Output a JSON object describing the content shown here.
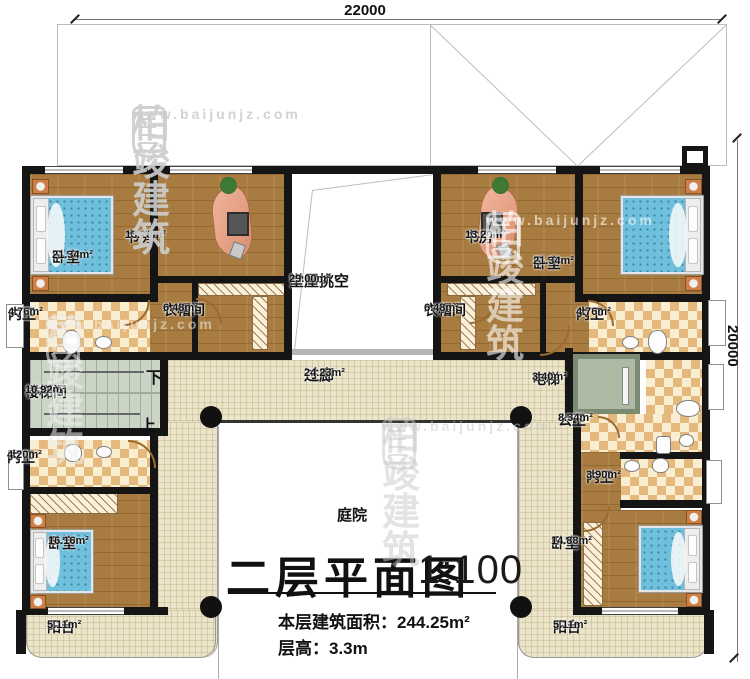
{
  "plan": {
    "title": "二层平面图",
    "scale": "1:100",
    "floor_area_label": "本层建筑面积：",
    "floor_area_value": "244.25m²",
    "floor_height_label": "层高：",
    "floor_height_value": "3.3m"
  },
  "dimensions": {
    "width_mm": "22000",
    "height_mm": "20000"
  },
  "stair": {
    "down": "下",
    "up": "上"
  },
  "watermark": {
    "brand": "柏竣建筑",
    "url": "www.baijunjz.com"
  },
  "rooms": [
    {
      "name": "卧室",
      "area": "21.34m²",
      "x": 127,
      "y": 250,
      "big": false
    },
    {
      "name": "书房",
      "area": "13.20m²",
      "x": 200,
      "y": 230,
      "big": false
    },
    {
      "name": "堂屋挑空",
      "area": "29.00m²",
      "x": 364,
      "y": 274,
      "big": true
    },
    {
      "name": "书房",
      "area": "13.20m²",
      "x": 540,
      "y": 230,
      "big": false
    },
    {
      "name": "卧室",
      "area": "21.34m²",
      "x": 608,
      "y": 256,
      "big": false
    },
    {
      "name": "内卫",
      "area": "4.76m²",
      "x": 83,
      "y": 307,
      "big": false
    },
    {
      "name": "衣帽间",
      "area": "6.48m²",
      "x": 238,
      "y": 303,
      "big": false
    },
    {
      "name": "衣帽间",
      "area": "6.48m²",
      "x": 499,
      "y": 303,
      "big": false
    },
    {
      "name": "内卫",
      "area": "4.76m²",
      "x": 651,
      "y": 307,
      "big": false
    },
    {
      "name": "楼梯间",
      "area": "10.92m²",
      "x": 100,
      "y": 385,
      "big": false
    },
    {
      "name": "过廊",
      "area": "24.23m²",
      "x": 379,
      "y": 368,
      "big": true
    },
    {
      "name": "电梯",
      "area": "3.40m²",
      "x": 607,
      "y": 372,
      "big": false
    },
    {
      "name": "公卫",
      "area": "8.34m²",
      "x": 633,
      "y": 413,
      "big": false
    },
    {
      "name": "内卫",
      "area": "4.20m²",
      "x": 82,
      "y": 450,
      "big": false
    },
    {
      "name": "内卫",
      "area": "3.90m²",
      "x": 661,
      "y": 470,
      "big": false
    },
    {
      "name": "卧室",
      "area": "16.16m²",
      "x": 123,
      "y": 536,
      "big": false
    },
    {
      "name": "卧室",
      "area": "14.88m²",
      "x": 626,
      "y": 536,
      "big": false
    },
    {
      "name": "阳台",
      "area": "5.11m²",
      "x": 122,
      "y": 620,
      "big": false
    },
    {
      "name": "阳台",
      "area": "5.11m²",
      "x": 628,
      "y": 620,
      "big": false
    },
    {
      "name": "庭院",
      "area": "",
      "x": 412,
      "y": 508,
      "big": true
    }
  ]
}
